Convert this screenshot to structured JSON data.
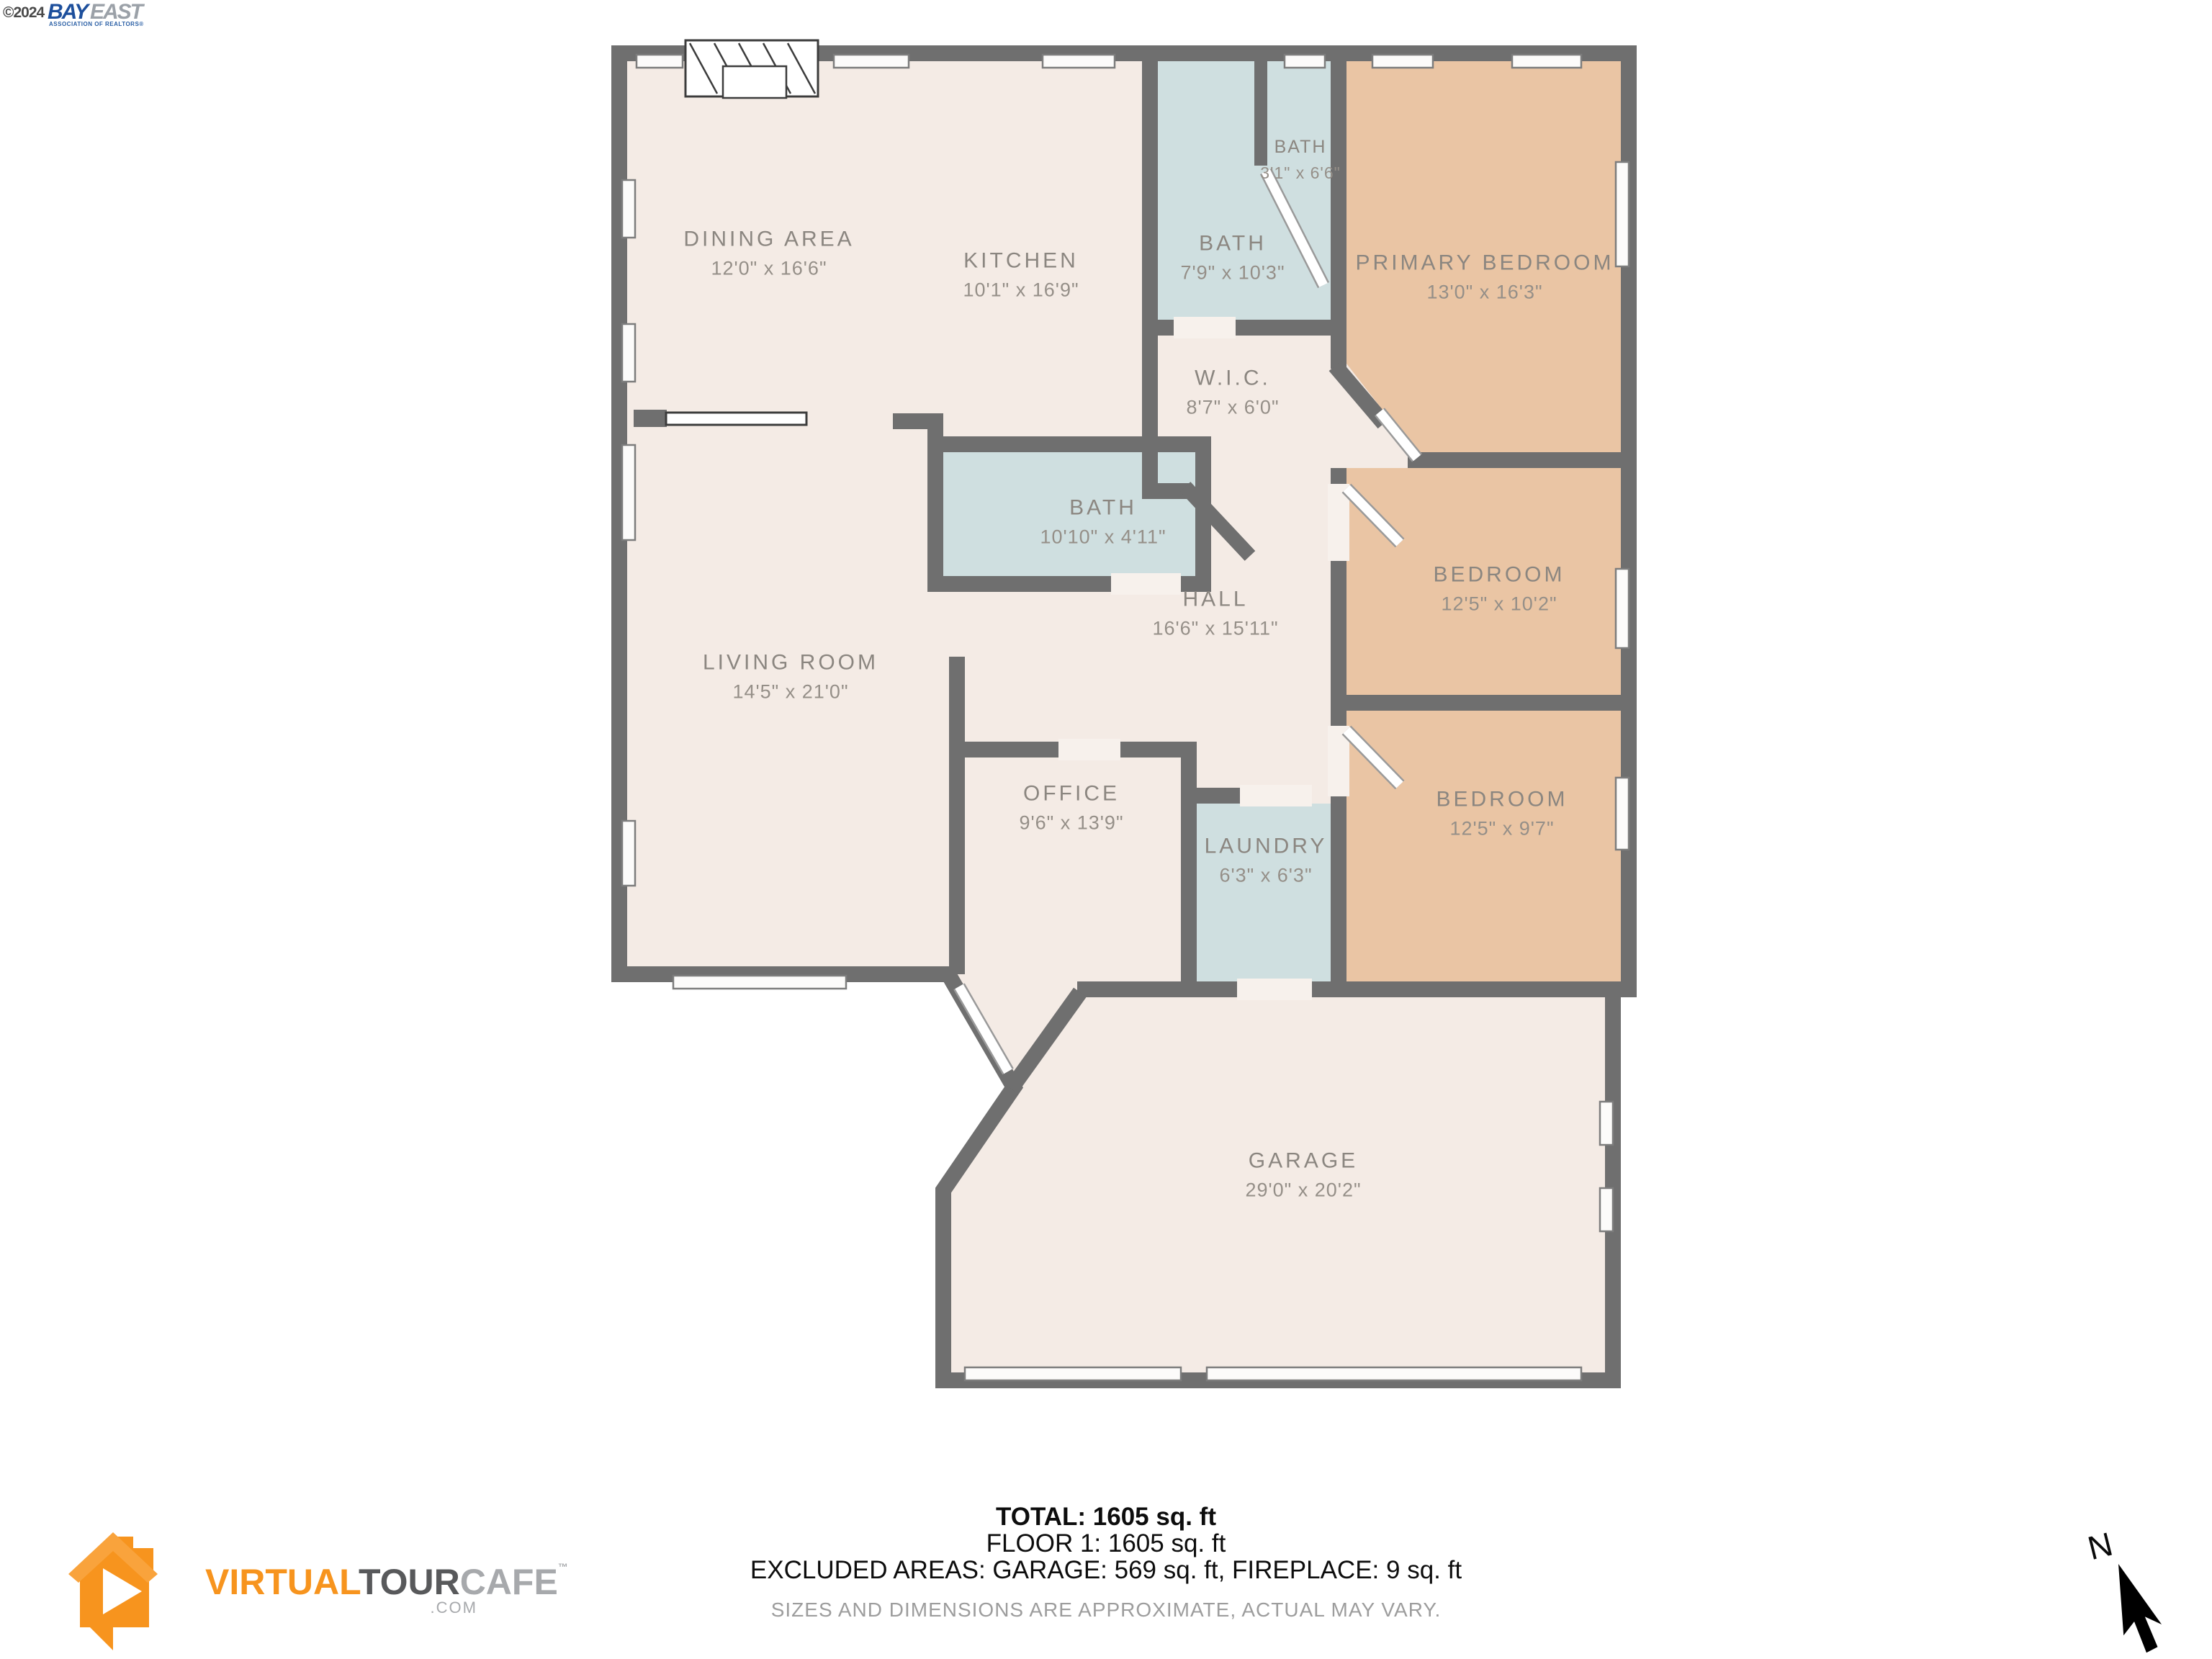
{
  "branding": {
    "copyright": "©2024",
    "association": {
      "name_part1": "BAY",
      "name_part2": "EAST",
      "subtitle": "ASSOCIATION OF REALTORS®"
    },
    "vtc": {
      "virtual": "VIRTUAL",
      "tour": "TOUR",
      "cafe": "CAFE",
      "tm": "™",
      "tld": ".COM"
    }
  },
  "rooms": [
    {
      "name": "DINING AREA",
      "dims": "12'0\" x 16'6\""
    },
    {
      "name": "KITCHEN",
      "dims": "10'1\" x 16'9\""
    },
    {
      "name": "BATH",
      "dims": "3'1\" x 6'6\""
    },
    {
      "name": "BATH",
      "dims": "7'9\" x 10'3\""
    },
    {
      "name": "PRIMARY BEDROOM",
      "dims": "13'0\" x 16'3\""
    },
    {
      "name": "W.I.C.",
      "dims": "8'7\" x 6'0\""
    },
    {
      "name": "BATH",
      "dims": "10'10\" x 4'11\""
    },
    {
      "name": "HALL",
      "dims": "16'6\" x 15'11\""
    },
    {
      "name": "BEDROOM",
      "dims": "12'5\" x 10'2\""
    },
    {
      "name": "LIVING ROOM",
      "dims": "14'5\" x 21'0\""
    },
    {
      "name": "OFFICE",
      "dims": "9'6\" x 13'9\""
    },
    {
      "name": "LAUNDRY",
      "dims": "6'3\" x 6'3\""
    },
    {
      "name": "BEDROOM",
      "dims": "12'5\" x 9'7\""
    },
    {
      "name": "GARAGE",
      "dims": "29'0\" x 20'2\""
    }
  ],
  "summary": {
    "total": "TOTAL: 1605 sq. ft",
    "floor": "FLOOR 1: 1605 sq. ft",
    "excluded": "EXCLUDED AREAS: GARAGE: 569 sq. ft, FIREPLACE: 9 sq. ft",
    "disclaimer": "SIZES AND DIMENSIONS ARE APPROXIMATE, ACTUAL MAY VARY."
  },
  "compass": {
    "label": "N"
  },
  "colors": {
    "wall": "#6f6f6f",
    "cream": "#f4ebe5",
    "cyan": "#cfdfe0",
    "tan": "#eac5a4",
    "label": "#8b8680",
    "dims": "#958f88",
    "accent": "#f7941e"
  }
}
